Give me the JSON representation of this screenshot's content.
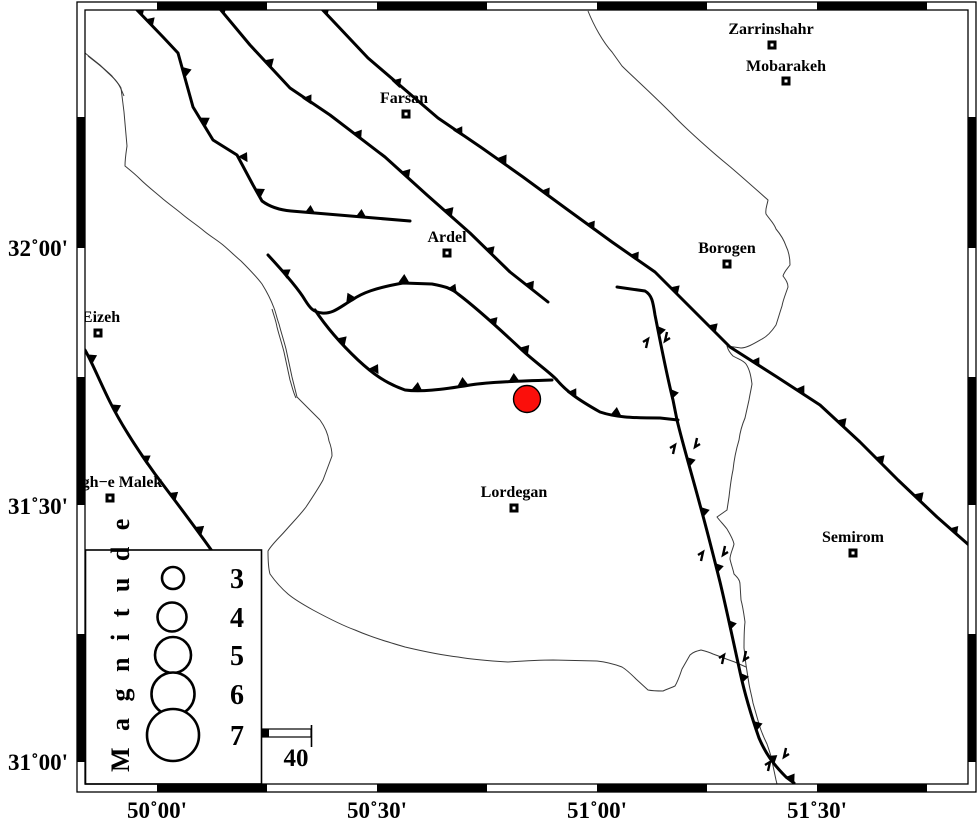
{
  "map": {
    "kind": "seismotectonic-map",
    "epicenter": {
      "symbol": "filled-circle",
      "color": "#fb0f0b"
    }
  },
  "cities": [
    {
      "name": "Zarrinshahr"
    },
    {
      "name": "Mobarakeh"
    },
    {
      "name": "Farsan"
    },
    {
      "name": "Ardel"
    },
    {
      "name": "Borogen"
    },
    {
      "name": "Eizeh"
    },
    {
      "name": "gh−e Malek"
    },
    {
      "name": "Lordegan"
    },
    {
      "name": "Semirom"
    }
  ],
  "axis": {
    "bottom": [
      "50˚00'",
      "50˚30'",
      "51˚00'",
      "51˚30'"
    ],
    "left": [
      "32˚00'",
      "31˚30'",
      "31˚00'"
    ]
  },
  "legend": {
    "title": "M a g n i t u d e",
    "entries": [
      {
        "label": "3"
      },
      {
        "label": "4"
      },
      {
        "label": "5"
      },
      {
        "label": "6"
      },
      {
        "label": "7"
      }
    ]
  },
  "scale": {
    "label": "40"
  }
}
